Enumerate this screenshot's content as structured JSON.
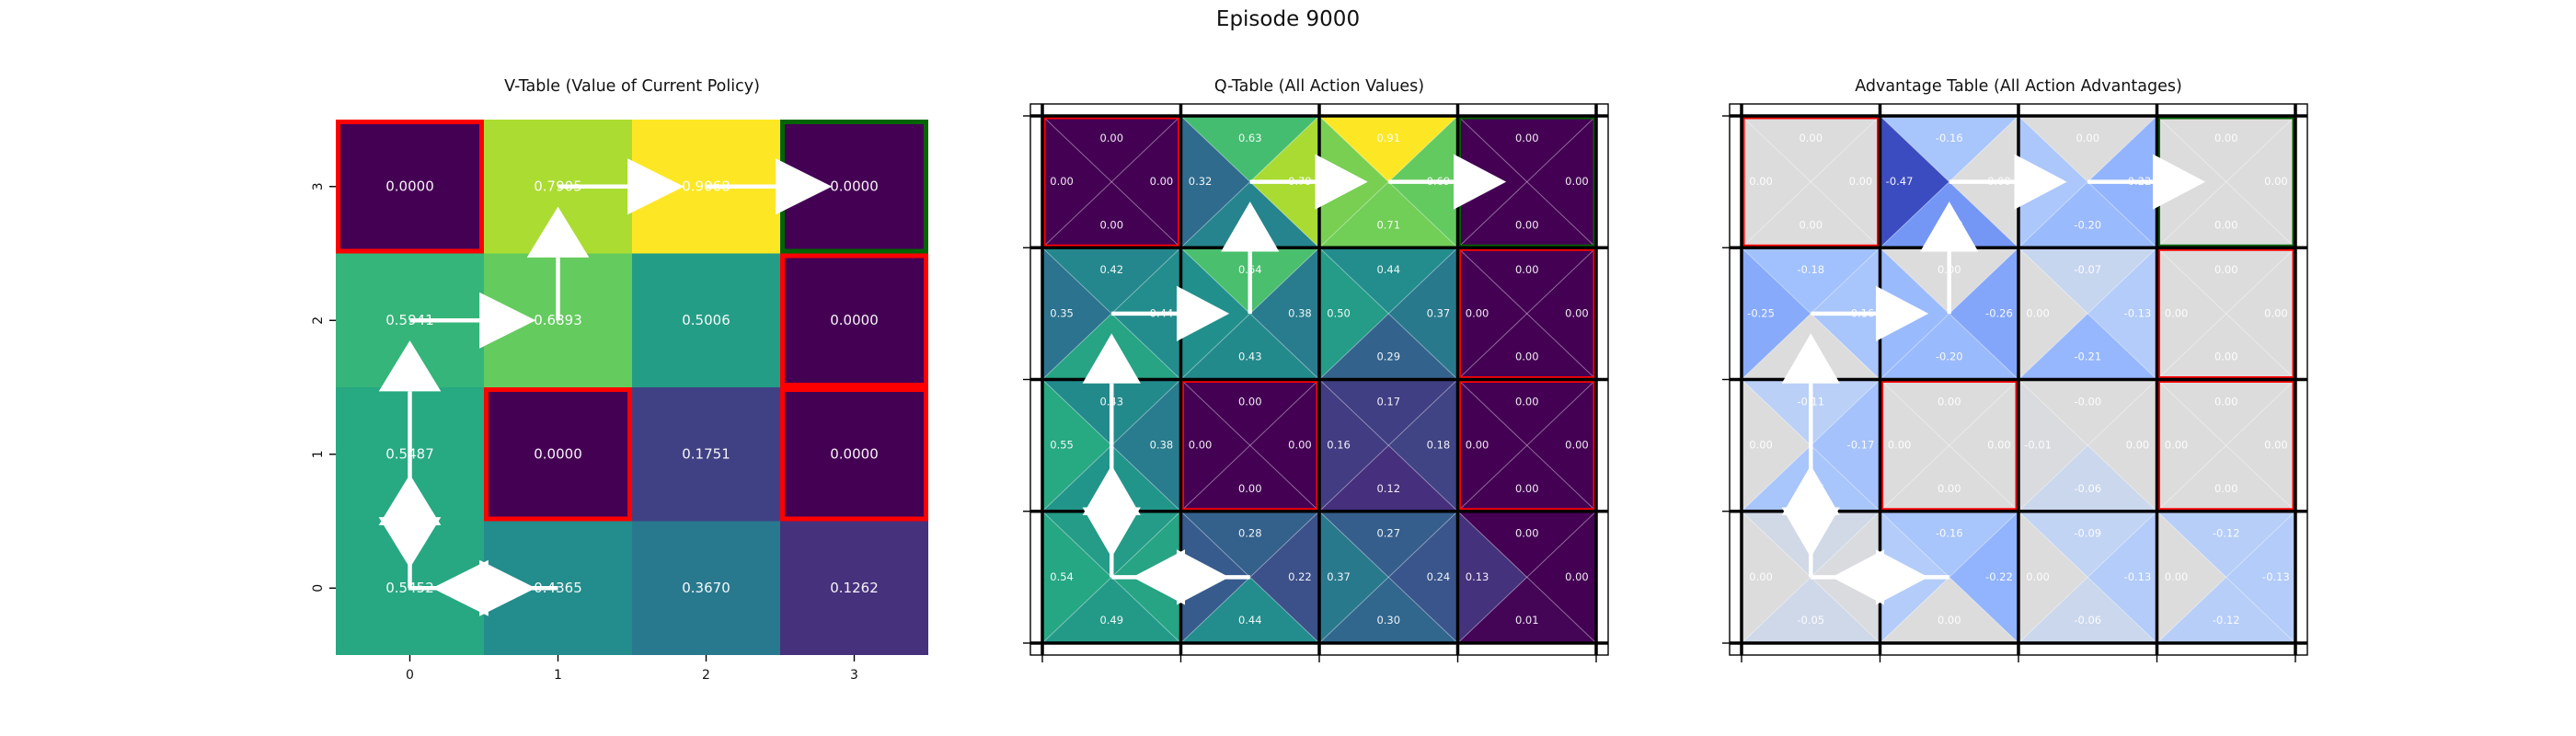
{
  "chart_data": {
    "type": "heatmap",
    "suptitle": "Episode 9000",
    "grid_size": 4,
    "action_order": [
      "up",
      "left",
      "right",
      "down"
    ],
    "colors": {
      "hole_border": "#ff0000",
      "goal_border": "#006400",
      "grid_line": "#000000",
      "arrow": "#ffffff",
      "cell_text": "#ffffff",
      "value_colormap": "viridis",
      "advantage_colormap": "coolwarm"
    },
    "policy_arrows": [
      {
        "col": 1,
        "row": 1,
        "dir": "up"
      },
      {
        "col": 1,
        "row": 0,
        "dir": "right"
      },
      {
        "col": 2,
        "row": 0,
        "dir": "right"
      },
      {
        "col": 0,
        "row": 1,
        "dir": "right"
      },
      {
        "col": 0,
        "row": 2,
        "dir": "up"
      },
      {
        "col": 0,
        "row": 3,
        "dir": "up"
      },
      {
        "col": 0,
        "row": 2,
        "dir": "down"
      },
      {
        "col": 1,
        "row": 3,
        "dir": "left"
      },
      {
        "col": 0,
        "row": 3,
        "dir": "right"
      }
    ],
    "panels": [
      {
        "id": "v",
        "title": "V-Table (Value of Current Policy)",
        "kind": "value",
        "vmin": 0,
        "vmax": 0.9068,
        "x_tick_labels": [
          "0",
          "1",
          "2",
          "3"
        ],
        "y_tick_labels": [
          "3",
          "2",
          "1",
          "0"
        ],
        "rows": [
          [
            {
              "v": "0.0000",
              "border": "red"
            },
            {
              "v": "0.7905"
            },
            {
              "v": "0.9068"
            },
            {
              "v": "0.0000",
              "border": "green"
            }
          ],
          [
            {
              "v": "0.5941"
            },
            {
              "v": "0.6893"
            },
            {
              "v": "0.5006"
            },
            {
              "v": "0.0000",
              "border": "red"
            }
          ],
          [
            {
              "v": "0.5487"
            },
            {
              "v": "0.0000",
              "border": "red"
            },
            {
              "v": "0.1751"
            },
            {
              "v": "0.0000",
              "border": "red"
            }
          ],
          [
            {
              "v": "0.5452"
            },
            {
              "v": "0.4365"
            },
            {
              "v": "0.3670"
            },
            {
              "v": "0.1262"
            }
          ]
        ]
      },
      {
        "id": "q",
        "title": "Q-Table (All Action Values)",
        "kind": "quad",
        "vmin": 0,
        "vmax": 0.91,
        "rows": [
          [
            {
              "a": [
                "0.00",
                "0.00",
                "0.00",
                "0.00"
              ],
              "border": "red"
            },
            {
              "a": [
                "0.63",
                "0.32",
                "0.79",
                "0.41"
              ]
            },
            {
              "a": [
                "0.91",
                "0.72",
                "0.69",
                "0.71"
              ]
            },
            {
              "a": [
                "0.00",
                "0.00",
                "0.00",
                "0.00"
              ],
              "border": "green"
            }
          ],
          [
            {
              "a": [
                "0.42",
                "0.35",
                "0.44",
                "0.53"
              ]
            },
            {
              "a": [
                "0.64",
                "0.45",
                "0.38",
                "0.43"
              ]
            },
            {
              "a": [
                "0.44",
                "0.50",
                "0.37",
                "0.29"
              ]
            },
            {
              "a": [
                "0.00",
                "0.00",
                "0.00",
                "0.00"
              ],
              "border": "red"
            }
          ],
          [
            {
              "a": [
                "0.43",
                "0.55",
                "0.38",
                "0.47"
              ]
            },
            {
              "a": [
                "0.00",
                "0.00",
                "0.00",
                "0.00"
              ],
              "border": "red"
            },
            {
              "a": [
                "0.17",
                "0.16",
                "0.18",
                "0.12"
              ]
            },
            {
              "a": [
                "0.00",
                "0.00",
                "0.00",
                "0.00"
              ],
              "border": "red"
            }
          ],
          [
            {
              "a": [
                "0.50",
                "0.54",
                "0.53",
                "0.49"
              ]
            },
            {
              "a": [
                "0.28",
                "0.26",
                "0.22",
                "0.44"
              ]
            },
            {
              "a": [
                "0.27",
                "0.37",
                "0.24",
                "0.30"
              ]
            },
            {
              "a": [
                "0.00",
                "0.13",
                "0.00",
                "0.01"
              ]
            }
          ]
        ]
      },
      {
        "id": "adv",
        "title": "Advantage Table (All Action Advantages)",
        "kind": "quad",
        "vmin": -0.47,
        "vmax": 0.47,
        "rows": [
          [
            {
              "a": [
                "0.00",
                "0.00",
                "0.00",
                "0.00"
              ],
              "border": "red"
            },
            {
              "a": [
                "-0.16",
                "-0.47",
                "0.00",
                "-0.30"
              ]
            },
            {
              "a": [
                "0.00",
                "-0.15",
                "-0.22",
                "-0.20"
              ]
            },
            {
              "a": [
                "0.00",
                "0.00",
                "0.00",
                "0.00"
              ],
              "border": "green"
            }
          ],
          [
            {
              "a": [
                "-0.18",
                "-0.25",
                "-0.16",
                "0.00"
              ]
            },
            {
              "a": [
                "0.00",
                "-0.20",
                "-0.26",
                "-0.20"
              ]
            },
            {
              "a": [
                "-0.07",
                "0.00",
                "-0.13",
                "-0.21"
              ]
            },
            {
              "a": [
                "0.00",
                "0.00",
                "0.00",
                "0.00"
              ],
              "border": "red"
            }
          ],
          [
            {
              "a": [
                "-0.11",
                "0.00",
                "-0.17",
                "-0.16"
              ]
            },
            {
              "a": [
                "0.00",
                "0.00",
                "0.00",
                "0.00"
              ],
              "border": "red"
            },
            {
              "a": [
                "-0.00",
                "-0.01",
                "0.00",
                "-0.06"
              ]
            },
            {
              "a": [
                "0.00",
                "0.00",
                "0.00",
                "0.00"
              ],
              "border": "red"
            }
          ],
          [
            {
              "a": [
                "-0.04",
                "0.00",
                "-0.01",
                "-0.05"
              ]
            },
            {
              "a": [
                "-0.16",
                "-0.13",
                "-0.22",
                "0.00"
              ]
            },
            {
              "a": [
                "-0.09",
                "0.00",
                "-0.13",
                "-0.06"
              ]
            },
            {
              "a": [
                "-0.12",
                "0.00",
                "-0.13",
                "-0.12"
              ]
            }
          ]
        ]
      }
    ]
  }
}
